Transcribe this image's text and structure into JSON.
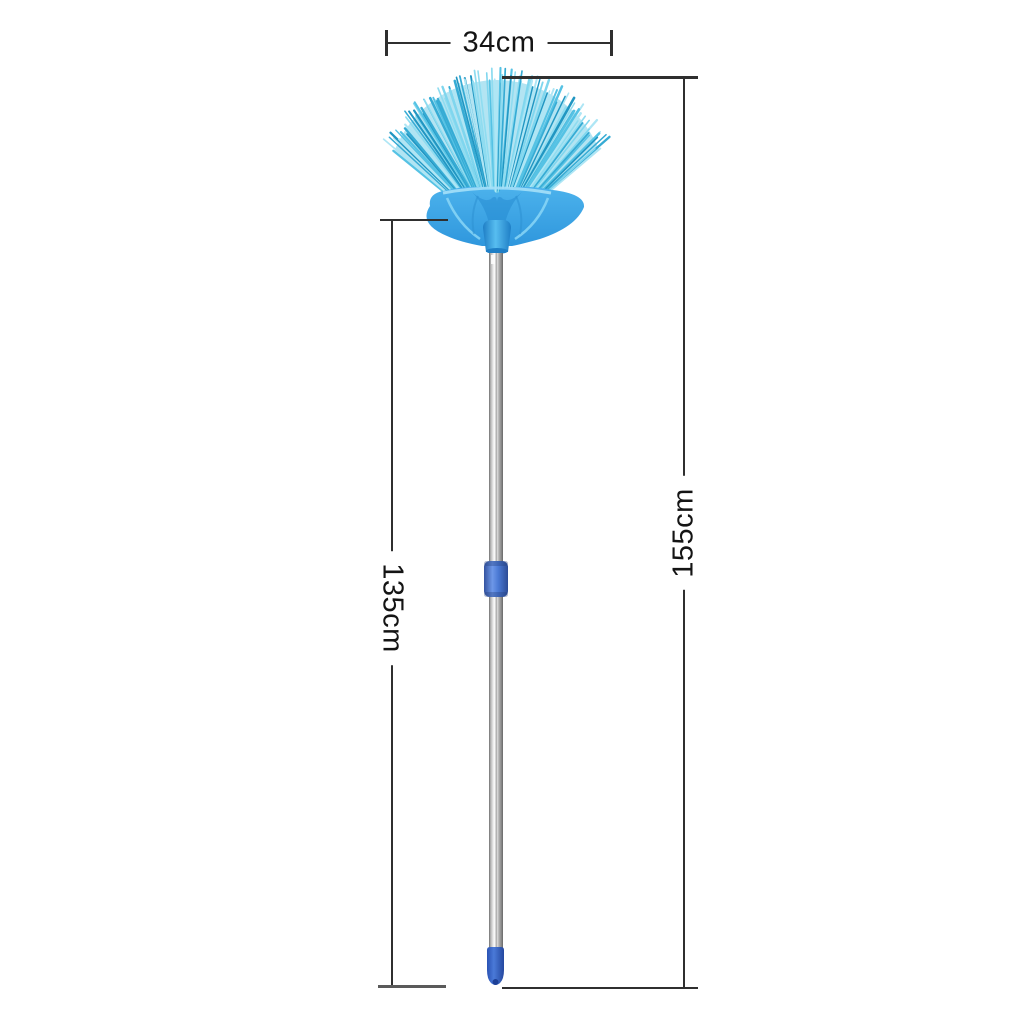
{
  "figure": {
    "type": "product-dimension-photo",
    "subject": "blue fan-shaped telescopic cobweb broom with stainless handle",
    "background": "#ffffff"
  },
  "dimensions": {
    "width": {
      "label": "34cm"
    },
    "total_length": {
      "label": "155cm"
    },
    "handle_length": {
      "label": "135cm"
    }
  },
  "colors": {
    "bristles": [
      "#aee6f5",
      "#7fd6ee",
      "#55c2e4",
      "#36abd4",
      "#2196c2",
      "#8fdcf0"
    ],
    "bristle_fill": "#74cde8",
    "head_plastic": "#3fa9e9",
    "head_detail_light": "#8fd9f7",
    "head_detail_dark": "#1f86cb",
    "pole_silver_light": "#f7f7f7",
    "pole_silver_dark": "#6e6e6e",
    "connector_blue": "#4a79d4",
    "end_cap_blue": "#2f5fc6",
    "dimension_line": "#2f2f2f",
    "label_text": "#141414"
  }
}
